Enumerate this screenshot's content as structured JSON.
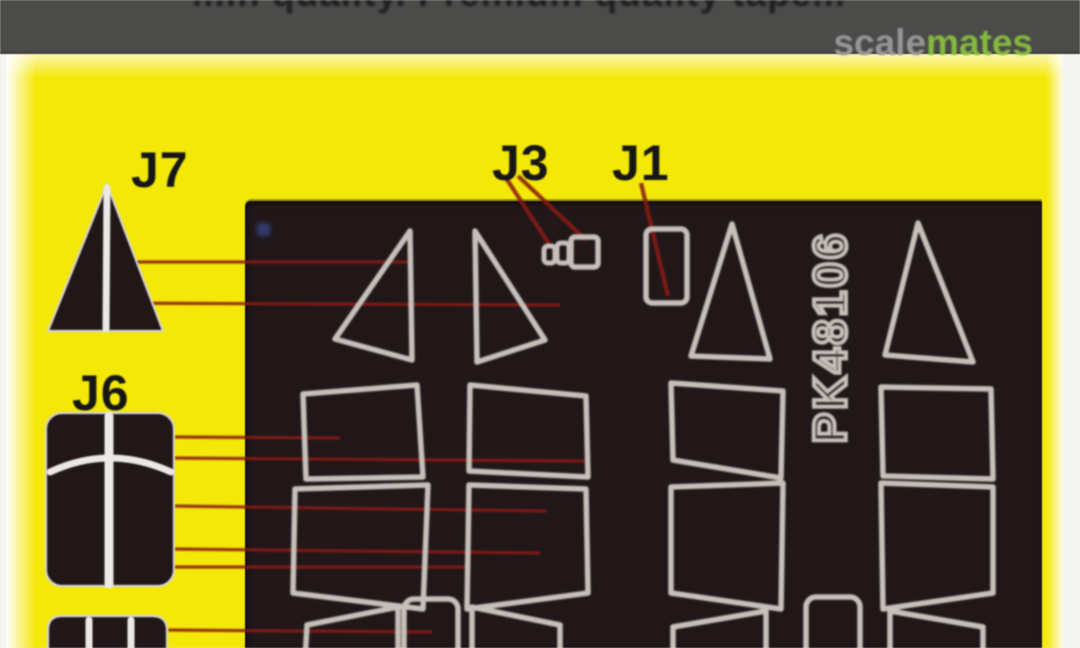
{
  "top_bar": {
    "cropped_text_illegible": "...in quality. Premium quality tape...",
    "watermark": {
      "prefix": "scale",
      "suffix": "mates"
    }
  },
  "labels": {
    "j7": "J7",
    "j6": "J6",
    "j3": "J3",
    "j1": "J1"
  },
  "sheet": {
    "part_number": "PK48106"
  },
  "colors": {
    "page_white": "#f5f5f3",
    "top_bar_bg": "#4b4b4a",
    "tape_yellow": "#f4e808",
    "sheet_dark": "#211719",
    "mask_outline": "#c6c0ba",
    "callout_red": "#8a1a14",
    "stripe_white": "#ece9e4",
    "label_black": "#161616",
    "watermark_gray": "#969696",
    "watermark_green": "#84b93f"
  }
}
